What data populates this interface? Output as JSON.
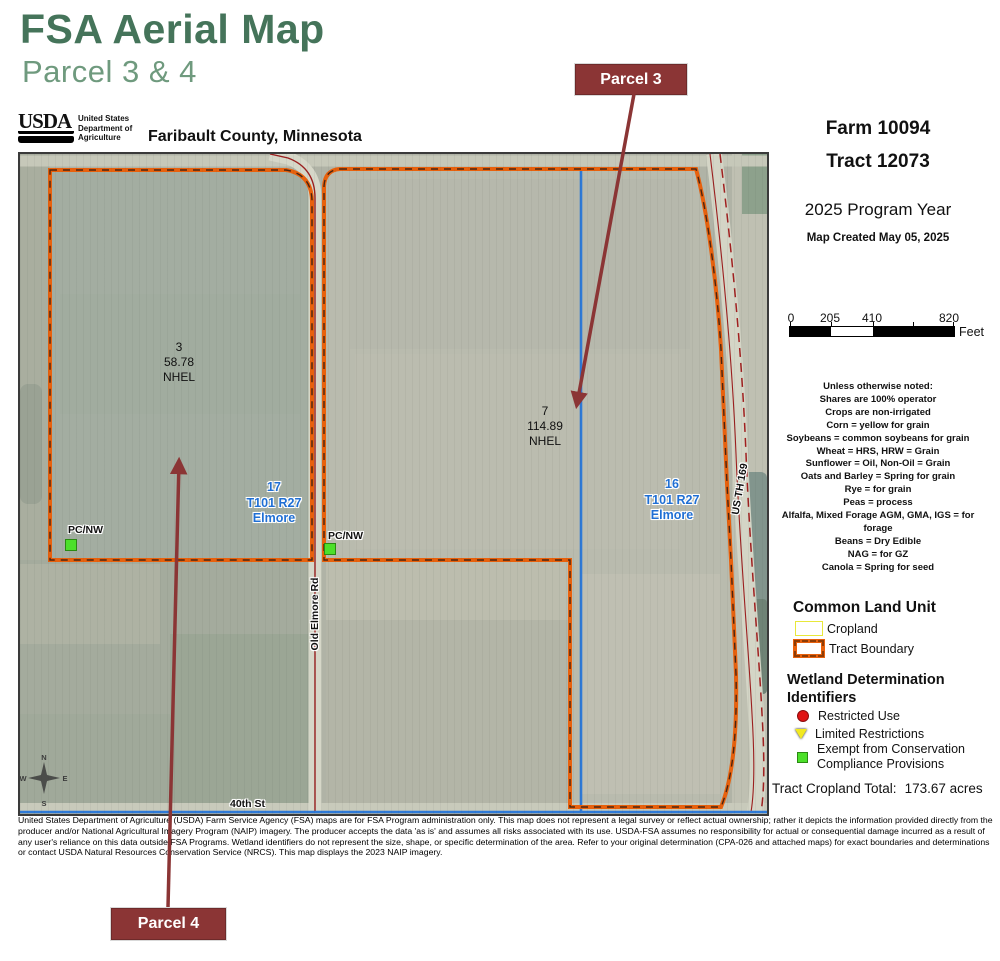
{
  "page": {
    "title": "FSA Aerial Map",
    "subtitle": "Parcel 3 & 4"
  },
  "header": {
    "usda_word": "USDA",
    "usda_lines": [
      "United States",
      "Department of",
      "Agriculture"
    ],
    "county": "Faribault County, Minnesota"
  },
  "callouts": {
    "parcel3": "Parcel 3",
    "parcel4": "Parcel 4"
  },
  "info": {
    "farm": "Farm 10094",
    "tract": "Tract 12073",
    "program_year": "2025 Program Year",
    "created": "Map Created May 05, 2025"
  },
  "scalebar": {
    "t0": "0",
    "t1": "205",
    "t2": "410",
    "t3": "820",
    "unit": "Feet"
  },
  "notes": [
    "Unless otherwise noted:",
    "Shares are 100% operator",
    "Crops are non-irrigated",
    "Corn = yellow for grain",
    "Soybeans = common soybeans for grain",
    "Wheat = HRS, HRW = Grain",
    "Sunflower = Oil, Non-Oil = Grain",
    "Oats and Barley = Spring for grain",
    "Rye = for grain",
    "Peas = process",
    "Alfalfa, Mixed Forage AGM, GMA, IGS = for forage",
    "Beans = Dry Edible",
    "NAG = for GZ",
    "Canola = Spring for seed"
  ],
  "legend": {
    "clu_title": "Common Land Unit",
    "cropland": "Cropland",
    "tract_boundary": "Tract Boundary",
    "wetland_title": "Wetland Determination Identifiers",
    "restricted": "Restricted Use",
    "limited": "Limited Restrictions",
    "exempt_line1": "Exempt from Conservation",
    "exempt_line2": "Compliance Provisions",
    "total_label": "Tract Cropland Total:",
    "total_value": "173.67 acres"
  },
  "map": {
    "fields": [
      {
        "id": "3",
        "acres": "58.78",
        "hel": "NHEL"
      },
      {
        "id": "7",
        "acres": "114.89",
        "hel": "NHEL"
      }
    ],
    "sections": [
      {
        "num": "17",
        "township": "T101 R27",
        "town": "Elmore"
      },
      {
        "num": "16",
        "township": "T101 R27",
        "town": "Elmore"
      }
    ],
    "wetland_points": [
      {
        "label": "PC/NW"
      },
      {
        "label": "PC/NW"
      }
    ],
    "roads": {
      "old_elmore": "Old Elmore Rd",
      "hwy169": "US TH 169",
      "fortieth": "40th St"
    },
    "compass": {
      "n": "N",
      "e": "E",
      "s": "S",
      "w": "W"
    }
  },
  "colors": {
    "title_green": "#45745a",
    "subtitle_green": "#6f9a7e",
    "callout_maroon": "#8b3535",
    "tract_orange": "#e8610d",
    "cropland_yellow": "#e8e83a",
    "section_blue": "#2e7ad8",
    "section_label_blue": "#1f6fd4",
    "road_red": "#9b1f1f",
    "wetland_green": "#4ce02a",
    "wetland_red": "#e01414",
    "wetland_yellow": "#f2e920"
  },
  "disclaimer": "United States Department of Agriculture (USDA) Farm Service Agency (FSA) maps are for FSA Program administration only.  This map does not represent a legal survey or reflect actual ownership; rather it depicts the information provided directly from the producer and/or National Agricultural Imagery Program (NAIP) imagery.  The producer accepts the data 'as is' and assumes all risks associated with its use.  USDA-FSA assumes no responsibility for actual or consequential damage incurred as a result of any user's reliance on this data outside FSA Programs.  Wetland identifiers do not represent the size, shape, or specific determination of the area.  Refer to your original determination (CPA-026 and attached maps) for exact boundaries and determinations or contact USDA Natural Resources Conservation Service (NRCS).  This map displays the 2023 NAIP imagery."
}
